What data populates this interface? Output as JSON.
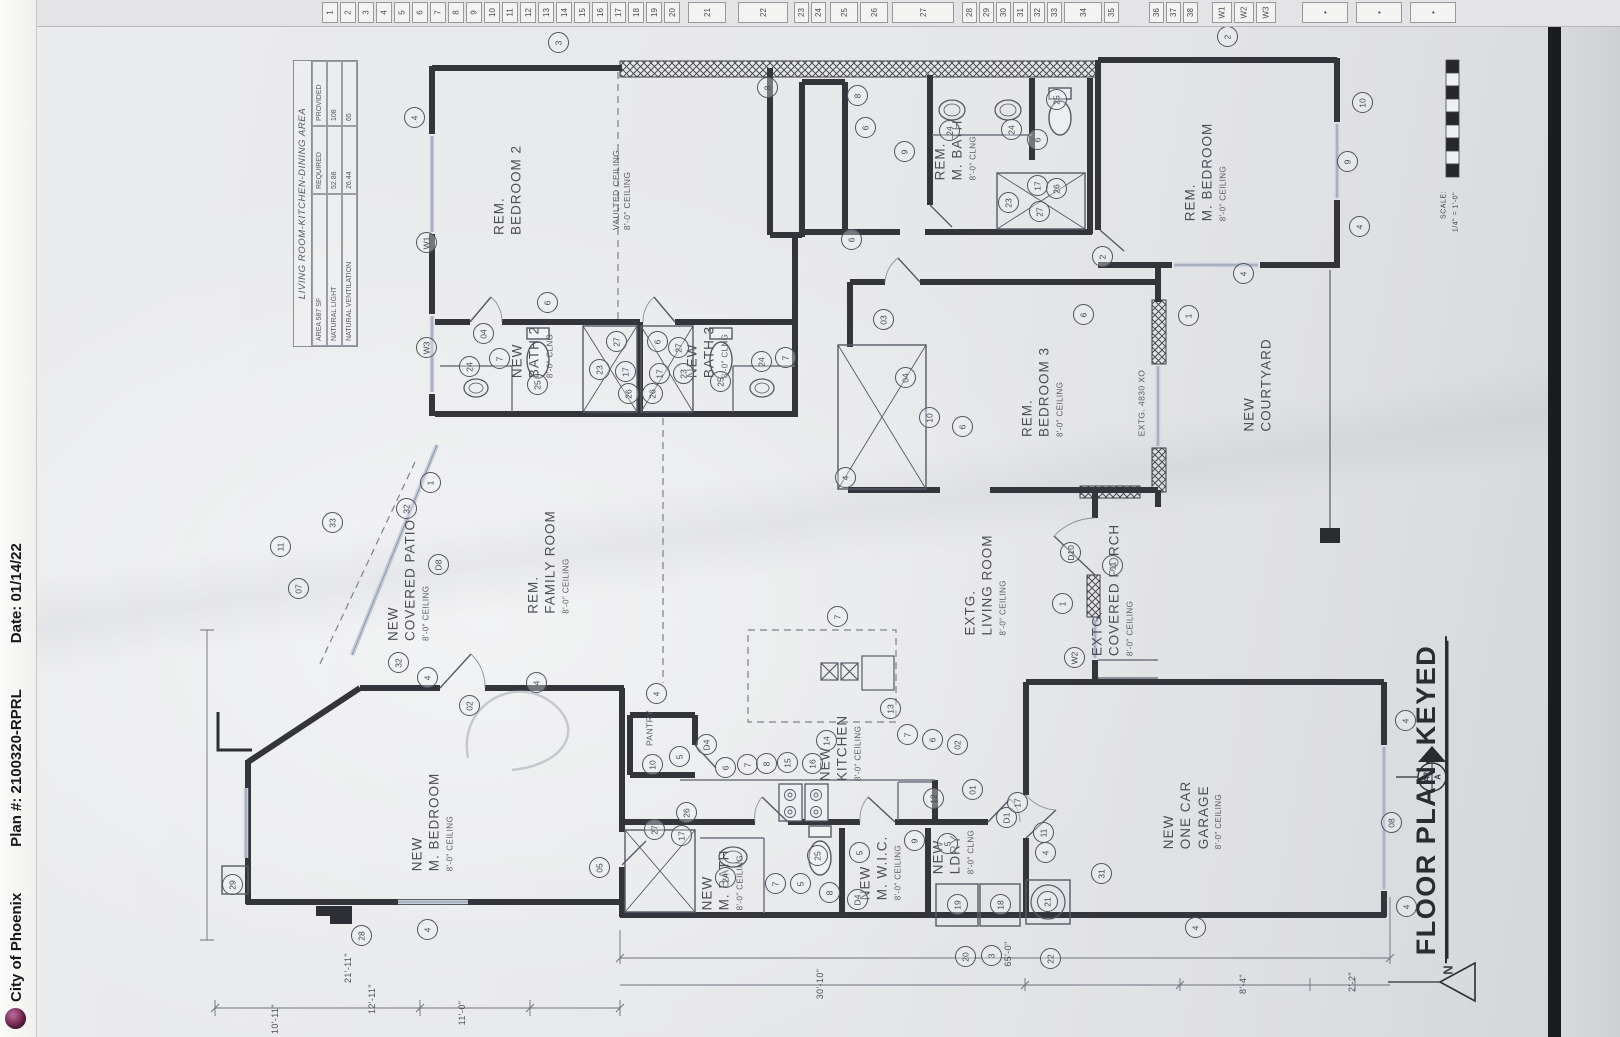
{
  "meta": {
    "left_strip": {
      "agency": "City of Phoenix",
      "plan_no": "Plan #: 2100320-RPRL",
      "date": "Date: 01/14/22"
    },
    "drawing_title": "FLOOR PLAN- KEYED",
    "north_label": "N",
    "section_marker": {
      "top": "A",
      "bottom": "A2"
    },
    "scale": {
      "label": "SCALE:",
      "value": "1/4\" = 1'-0\""
    },
    "colors": {
      "paper": "#e7e8ea",
      "ink": "#34353b",
      "window": "#c6ccd8",
      "logo": "#7c2d56"
    }
  },
  "keyed_strip": {
    "start_x": 322,
    "cells": [
      "1",
      "2",
      "3",
      "4",
      "5",
      "6",
      "7",
      "8",
      "9",
      "10",
      "11",
      "12",
      "13",
      "14",
      "15",
      "16",
      "17",
      "18",
      "19",
      "20",
      [
        "",
        6
      ],
      [
        "21",
        38
      ],
      [
        "",
        10
      ],
      [
        "22",
        50
      ],
      [
        "",
        4
      ],
      [
        "23",
        15
      ],
      [
        "24",
        15
      ],
      [
        "",
        2
      ],
      [
        "25",
        28
      ],
      [
        "26",
        28
      ],
      [
        "",
        2
      ],
      [
        "27",
        62
      ],
      [
        "",
        6
      ],
      [
        "28",
        15
      ],
      [
        "29",
        15
      ],
      [
        "30",
        15
      ],
      [
        "31",
        15
      ],
      [
        "32",
        15
      ],
      [
        "33",
        15
      ],
      [
        "34",
        38
      ],
      [
        "35",
        15
      ],
      [
        "",
        28
      ],
      [
        "36",
        15
      ],
      [
        "37",
        15
      ],
      [
        "38",
        15
      ],
      [
        "",
        12
      ],
      [
        "W1",
        20
      ],
      [
        "W2",
        20
      ],
      [
        "W3",
        20
      ],
      [
        "",
        24
      ],
      [
        "•",
        46
      ],
      [
        "",
        6
      ],
      [
        "•",
        46
      ],
      [
        "",
        6
      ],
      [
        "•",
        46
      ]
    ]
  },
  "area_table": {
    "title": "LIVING ROOM-KITCHEN-DINING AREA",
    "corner": "AREA 587 SF",
    "col_required": "REQUIRED",
    "col_provided": "PROVIDED",
    "rows": [
      {
        "label": "NATURAL LIGHT",
        "required": "52.88",
        "provided": "108"
      },
      {
        "label": "NATURAL VENTILATION",
        "required": "26.44",
        "provided": "65"
      }
    ]
  },
  "rooms": [
    {
      "id": "rem-bedroom-2",
      "lines": [
        "REM.",
        "BEDROOM  2"
      ],
      "ceiling": "",
      "x": 508,
      "y": 190
    },
    {
      "id": "vaulted-ceiling-note",
      "lines": [
        "VAULTED CEILING",
        "8'-0\" CEILING"
      ],
      "ceiling": "",
      "x": 622,
      "y": 190,
      "cls": "note"
    },
    {
      "id": "rem-m-bath",
      "lines": [
        "REM.",
        "M. BATH"
      ],
      "ceiling": "8'-0\" CLNG",
      "x": 955,
      "y": 150
    },
    {
      "id": "rem-m-bedroom",
      "lines": [
        "REM.",
        "M. BEDROOM"
      ],
      "ceiling": "8'-0\" CEILING",
      "x": 1205,
      "y": 172
    },
    {
      "id": "new-bath-2",
      "lines": [
        "NEW",
        "BATH  2"
      ],
      "ceiling": "8'-0\" CLNG",
      "x": 532,
      "y": 352
    },
    {
      "id": "new-bath-3",
      "lines": [
        "NEW",
        "BATH  3"
      ],
      "ceiling": "8'-0\" CLNG",
      "x": 707,
      "y": 352
    },
    {
      "id": "rem-bedroom-3",
      "lines": [
        "REM.",
        "BEDROOM  3"
      ],
      "ceiling": "8'-0\" CEILING",
      "x": 1042,
      "y": 392
    },
    {
      "id": "new-courtyard",
      "lines": [
        "NEW",
        "COURTYARD"
      ],
      "ceiling": "",
      "x": 1258,
      "y": 385
    },
    {
      "id": "extg-window-4830",
      "lines": [
        "EXTG.  4830  XO"
      ],
      "ceiling": "",
      "x": 1142,
      "y": 403,
      "cls": "note"
    },
    {
      "id": "rem-family-room",
      "lines": [
        "REM.",
        "FAMILY  ROOM"
      ],
      "ceiling": "8'-0\" CEILING",
      "x": 548,
      "y": 562
    },
    {
      "id": "new-covered-patio",
      "lines": [
        "NEW",
        "COVERED  PATIO"
      ],
      "ceiling": "8'-0\" CEILING",
      "x": 408,
      "y": 580
    },
    {
      "id": "extg-living-room",
      "lines": [
        "EXTG.",
        "LIVING  ROOM"
      ],
      "ceiling": "8'-0\" CEILING",
      "x": 985,
      "y": 585
    },
    {
      "id": "extg-covered-porch",
      "lines": [
        "EXTG.",
        "COVERED  PORCH"
      ],
      "ceiling": "8'-0\" CEILING",
      "x": 1112,
      "y": 590
    },
    {
      "id": "new-kitchen",
      "lines": [
        "NEW",
        "KITCHEN"
      ],
      "ceiling": "8'-0\" CEILING",
      "x": 840,
      "y": 748
    },
    {
      "id": "pantry",
      "lines": [
        "PANTRY"
      ],
      "ceiling": "",
      "x": 650,
      "y": 728,
      "cls": "note"
    },
    {
      "id": "new-m-bedroom",
      "lines": [
        "NEW",
        "M. BEDROOM"
      ],
      "ceiling": "8'-0\" CEILING",
      "x": 432,
      "y": 822
    },
    {
      "id": "new-m-bath",
      "lines": [
        "NEW",
        "M. BATH"
      ],
      "ceiling": "8'-0\" CEILING",
      "x": 722,
      "y": 880
    },
    {
      "id": "new-m-wic",
      "lines": [
        "NEW",
        "M. W.I.C."
      ],
      "ceiling": "8'-0\" CEILING",
      "x": 880,
      "y": 868
    },
    {
      "id": "new-ldry",
      "lines": [
        "NEW",
        "LDRY"
      ],
      "ceiling": "8'-0\" CLNG",
      "x": 953,
      "y": 852
    },
    {
      "id": "new-one-car-garage",
      "lines": [
        "NEW",
        "ONE  CAR",
        "GARAGE"
      ],
      "ceiling": "8'-0\" CEILING",
      "x": 1192,
      "y": 815
    }
  ],
  "bubbles": [
    [
      415,
      118,
      "4"
    ],
    [
      559,
      43,
      "3"
    ],
    [
      1228,
      37,
      "2"
    ],
    [
      427,
      243,
      "W1"
    ],
    [
      427,
      348,
      "W3"
    ],
    [
      548,
      303,
      "6"
    ],
    [
      484,
      334,
      "04"
    ],
    [
      500,
      359,
      "7"
    ],
    [
      470,
      367,
      "24"
    ],
    [
      538,
      385,
      "25"
    ],
    [
      600,
      370,
      "23"
    ],
    [
      617,
      342,
      "27"
    ],
    [
      626,
      372,
      "17"
    ],
    [
      629,
      394,
      "26"
    ],
    [
      658,
      342,
      "6"
    ],
    [
      679,
      348,
      "27"
    ],
    [
      660,
      374,
      "17"
    ],
    [
      684,
      374,
      "23"
    ],
    [
      653,
      394,
      "26"
    ],
    [
      721,
      382,
      "25"
    ],
    [
      762,
      362,
      "24"
    ],
    [
      786,
      358,
      "7"
    ],
    [
      768,
      88,
      "8"
    ],
    [
      858,
      96,
      "8"
    ],
    [
      866,
      128,
      "6"
    ],
    [
      905,
      152,
      "9"
    ],
    [
      950,
      131,
      "24"
    ],
    [
      1012,
      130,
      "24"
    ],
    [
      1057,
      100,
      "25"
    ],
    [
      1038,
      140,
      "6"
    ],
    [
      1009,
      203,
      "23"
    ],
    [
      1038,
      186,
      "17"
    ],
    [
      1057,
      189,
      "26"
    ],
    [
      1040,
      212,
      "27"
    ],
    [
      852,
      240,
      "6"
    ],
    [
      884,
      320,
      "03"
    ],
    [
      906,
      378,
      "04"
    ],
    [
      930,
      418,
      "10"
    ],
    [
      846,
      478,
      "4"
    ],
    [
      963,
      427,
      "6"
    ],
    [
      1084,
      315,
      "6"
    ],
    [
      1189,
      316,
      "1"
    ],
    [
      1103,
      257,
      "2"
    ],
    [
      1363,
      103,
      "10"
    ],
    [
      1348,
      162,
      "9"
    ],
    [
      1360,
      227,
      "4"
    ],
    [
      1244,
      274,
      "4"
    ],
    [
      1071,
      553,
      "D10"
    ],
    [
      1113,
      566,
      "11"
    ],
    [
      1063,
      604,
      "1"
    ],
    [
      1075,
      658,
      "W2"
    ],
    [
      431,
      483,
      "1"
    ],
    [
      407,
      509,
      "32"
    ],
    [
      439,
      565,
      "D8"
    ],
    [
      399,
      663,
      "32"
    ],
    [
      333,
      523,
      "33"
    ],
    [
      281,
      547,
      "11"
    ],
    [
      299,
      589,
      "07"
    ],
    [
      838,
      617,
      "7"
    ],
    [
      891,
      709,
      "13"
    ],
    [
      827,
      741,
      "14"
    ],
    [
      657,
      694,
      "4"
    ],
    [
      537,
      683,
      "4"
    ],
    [
      653,
      765,
      "10"
    ],
    [
      680,
      757,
      "5"
    ],
    [
      707,
      745,
      "D4"
    ],
    [
      726,
      768,
      "6"
    ],
    [
      748,
      765,
      "7"
    ],
    [
      767,
      764,
      "8"
    ],
    [
      788,
      763,
      "15"
    ],
    [
      813,
      764,
      "16"
    ],
    [
      908,
      735,
      "7"
    ],
    [
      933,
      740,
      "6"
    ],
    [
      958,
      745,
      "02"
    ],
    [
      428,
      678,
      "4"
    ],
    [
      470,
      706,
      "02"
    ],
    [
      600,
      868,
      "05"
    ],
    [
      233,
      885,
      "29"
    ],
    [
      362,
      936,
      "28"
    ],
    [
      428,
      930,
      "4"
    ],
    [
      655,
      830,
      "27"
    ],
    [
      687,
      813,
      "26"
    ],
    [
      682,
      836,
      "17"
    ],
    [
      726,
      878,
      "24"
    ],
    [
      776,
      884,
      "7"
    ],
    [
      801,
      884,
      "5"
    ],
    [
      818,
      856,
      "25"
    ],
    [
      830,
      893,
      "8"
    ],
    [
      860,
      853,
      "5"
    ],
    [
      858,
      900,
      "D4"
    ],
    [
      915,
      841,
      "9"
    ],
    [
      948,
      844,
      "5"
    ],
    [
      934,
      799,
      "12"
    ],
    [
      958,
      905,
      "19"
    ],
    [
      1001,
      905,
      "18"
    ],
    [
      1048,
      902,
      "21"
    ],
    [
      1007,
      818,
      "D1"
    ],
    [
      1044,
      833,
      "11"
    ],
    [
      1046,
      853,
      "4"
    ],
    [
      1102,
      874,
      "31"
    ],
    [
      966,
      957,
      "20"
    ],
    [
      992,
      956,
      "3"
    ],
    [
      1051,
      959,
      "22"
    ],
    [
      973,
      790,
      "01"
    ],
    [
      1018,
      803,
      "17"
    ],
    [
      1406,
      721,
      "4"
    ],
    [
      1392,
      823,
      "08"
    ],
    [
      1407,
      907,
      "4"
    ],
    [
      1196,
      928,
      "4"
    ]
  ],
  "dimensions": [
    [
      1008,
      954,
      "65'-0\""
    ],
    [
      820,
      984,
      "30'-10\""
    ],
    [
      1243,
      984,
      "8'-4\""
    ],
    [
      1352,
      982,
      "2'-2\""
    ],
    [
      348,
      968,
      "21'-11\""
    ],
    [
      372,
      999,
      "12'-11\""
    ],
    [
      462,
      1013,
      "11'-0\""
    ],
    [
      275,
      1019,
      "10'-11\""
    ]
  ]
}
